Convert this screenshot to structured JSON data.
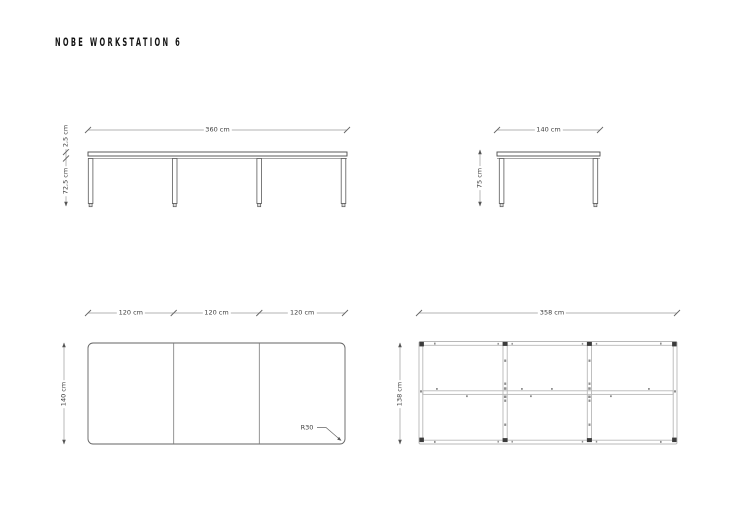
{
  "page": {
    "title": "NOBE WORKSTATION 6"
  },
  "colors": {
    "ink": "#141414",
    "drawing_line": "#5a5a5a",
    "dimension_line": "#999999",
    "frame_rail": "#b8b8b8",
    "bracket": "#3c3c3c"
  },
  "views": {
    "front_elevation": {
      "width_label": "360 cm",
      "top_thickness_label": "2,5 cm",
      "leg_height_label": "72,5 cm"
    },
    "side_elevation": {
      "width_label": "140 cm",
      "height_label": "75 cm"
    },
    "top_plan": {
      "segment_labels": [
        "120 cm",
        "120 cm",
        "120 cm"
      ],
      "depth_label": "140 cm",
      "corner_radius_label": "R30"
    },
    "frame_plan": {
      "width_label": "358 cm",
      "depth_label": "138 cm"
    }
  }
}
